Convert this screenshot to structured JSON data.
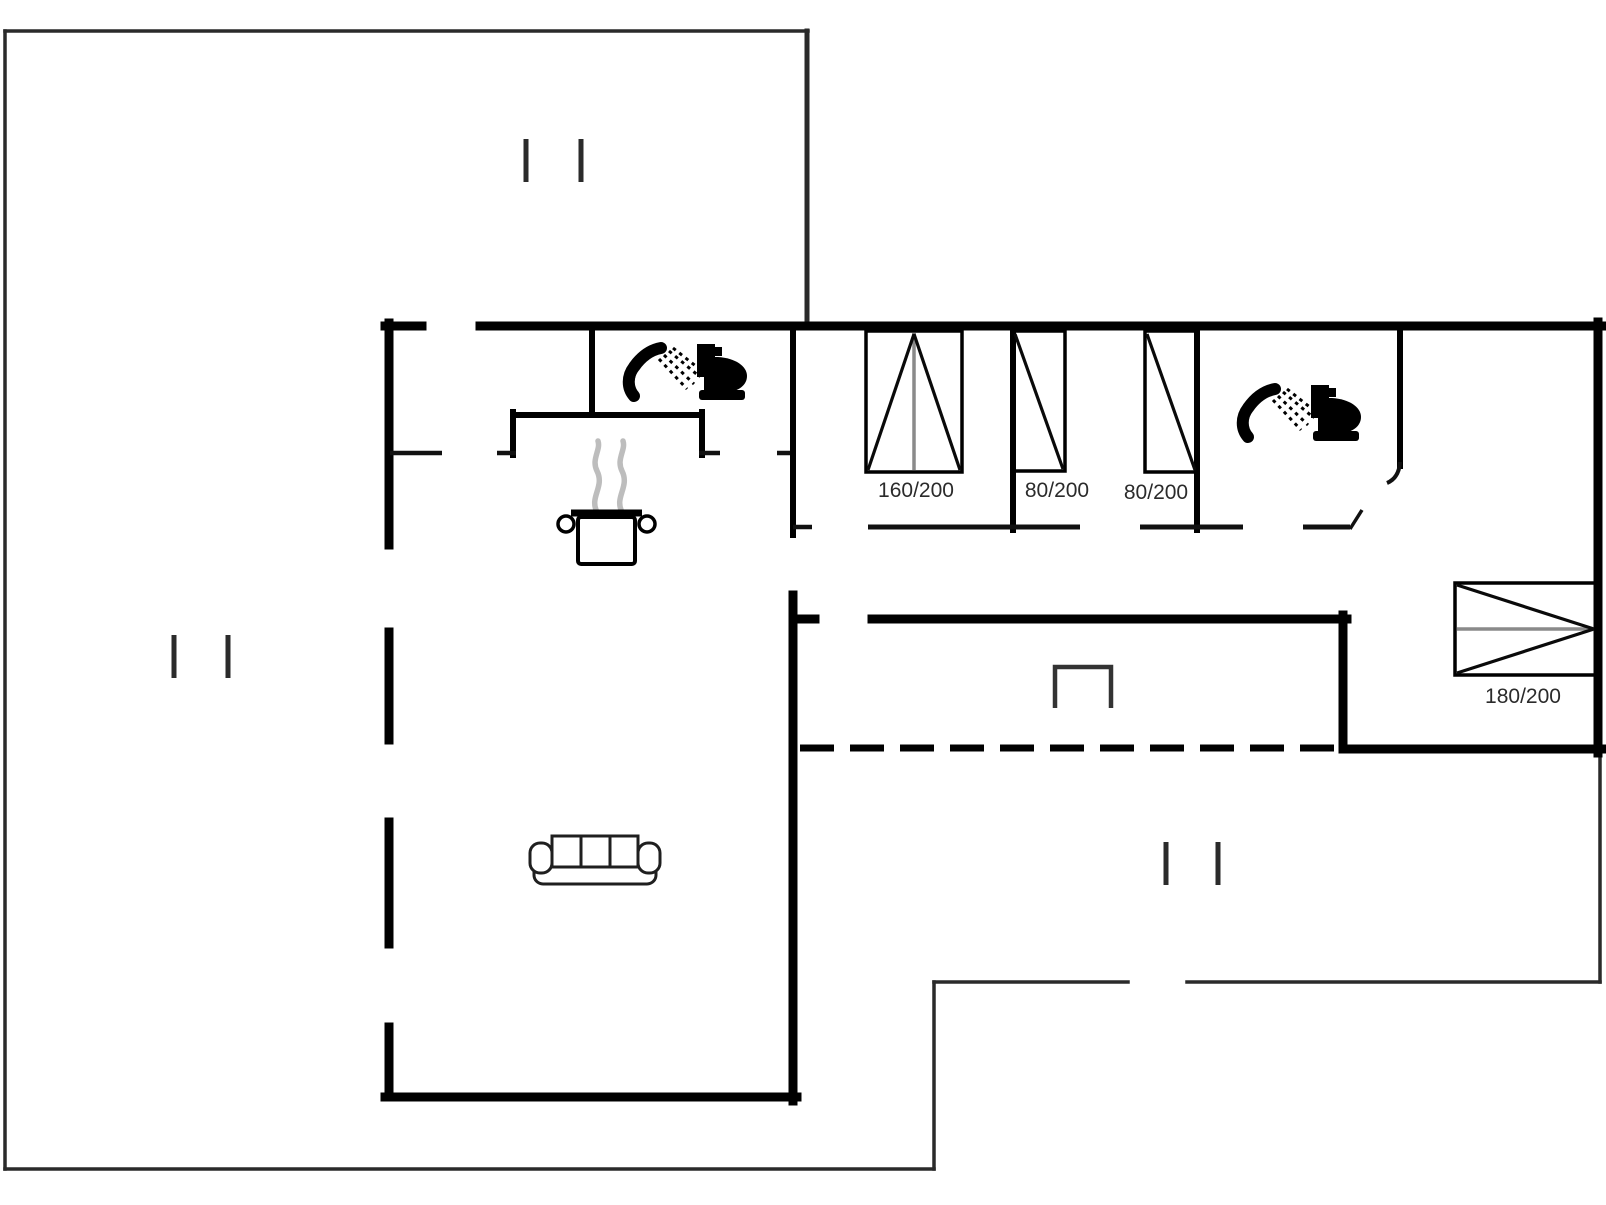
{
  "plan": {
    "type": "floor-plan",
    "bed_labels": {
      "double_bed": "160/200",
      "single_bed_a": "80/200",
      "single_bed_b": "80/200",
      "master_bed": "180/200"
    },
    "colors": {
      "background": "#ffffff",
      "wall": "#000000",
      "terrace_outline": "#2a2a2a",
      "bed_midline": "#8a8a8a",
      "steam": "#bdbdbd",
      "label_text": "#2b2b2b"
    },
    "icons": [
      "shower-icon",
      "toilet-icon",
      "cooking-pot-icon",
      "steam-icon",
      "sofa-icon",
      "grill-symbol",
      "window-tick-icon",
      "door-swing-icon",
      "bed-symbol"
    ]
  }
}
